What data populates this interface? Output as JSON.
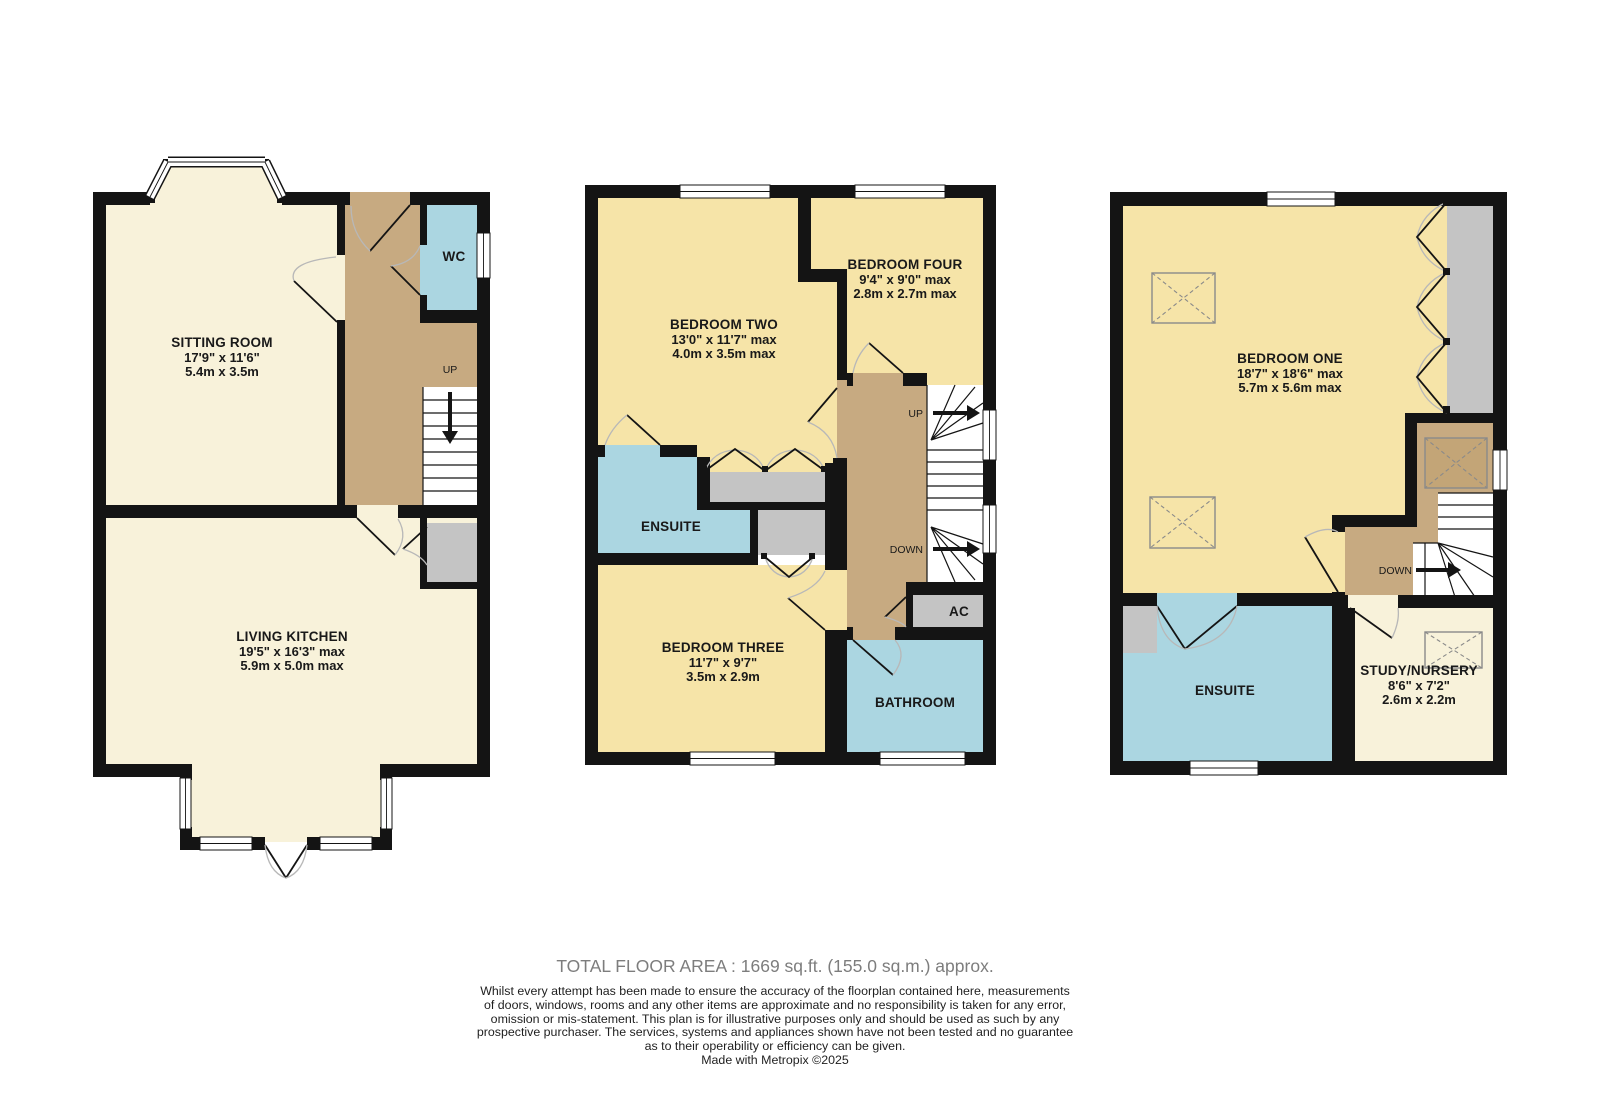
{
  "colors": {
    "wall": "#141414",
    "room_cream": "#F8F2DA",
    "room_yellow": "#F6E4A8",
    "room_blue": "#ABD6E1",
    "hall_brown": "#C7AA81",
    "storage_gray": "#C4C4C4"
  },
  "floors": {
    "ground": {
      "rooms": [
        {
          "name": "SITTING ROOM",
          "dims_imperial": "17'9\" x 11'6\"",
          "dims_metric": "5.4m x 3.5m"
        },
        {
          "name": "WC"
        },
        {
          "name": "LIVING KITCHEN",
          "dims_imperial": "19'5\" x 16'3\" max",
          "dims_metric": "5.9m x 5.0m max"
        }
      ],
      "up_label": "UP"
    },
    "first": {
      "rooms": [
        {
          "name": "BEDROOM TWO",
          "dims_imperial": "13'0\" x 11'7\" max",
          "dims_metric": "4.0m x 3.5m max"
        },
        {
          "name": "BEDROOM FOUR",
          "dims_imperial": "9'4\" x 9'0\" max",
          "dims_metric": "2.8m x 2.7m max"
        },
        {
          "name": "ENSUITE"
        },
        {
          "name": "BEDROOM THREE",
          "dims_imperial": "11'7\" x 9'7\"",
          "dims_metric": "3.5m x 2.9m"
        },
        {
          "name": "BATHROOM"
        },
        {
          "name": "AC"
        }
      ],
      "up_label": "UP",
      "down_label": "DOWN"
    },
    "second": {
      "rooms": [
        {
          "name": "BEDROOM ONE",
          "dims_imperial": "18'7\" x 18'6\" max",
          "dims_metric": "5.7m x 5.6m max"
        },
        {
          "name": "ENSUITE"
        },
        {
          "name": "STUDY/NURSERY",
          "dims_imperial": "8'6\" x 7'2\"",
          "dims_metric": "2.6m x 2.2m"
        }
      ],
      "down_label": "DOWN"
    }
  },
  "footer": {
    "total_area": "TOTAL FLOOR AREA : 1669 sq.ft. (155.0 sq.m.) approx.",
    "disclaimer": [
      "Whilst every attempt has been made to ensure the accuracy of the floorplan contained here, measurements",
      "of doors, windows, rooms and any other items are approximate and no responsibility is taken for any error,",
      "omission or mis-statement. This plan is for illustrative purposes only and should be used as such by any",
      "prospective purchaser. The services, systems and appliances shown have not been tested and no guarantee",
      "as to their operability or efficiency can be given."
    ],
    "credit": "Made with Metropix ©2025"
  }
}
